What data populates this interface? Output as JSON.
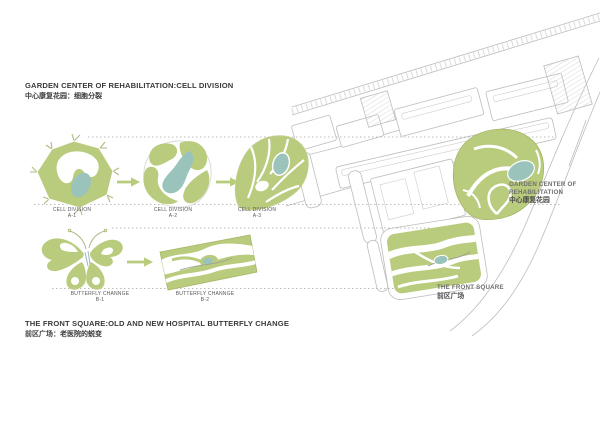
{
  "page": {
    "background": "#ffffff"
  },
  "colors": {
    "olive": "#b9cb7d",
    "olive-stroke": "#a6b665",
    "teal": "#9ac3bb",
    "map-line": "#bdbdbd",
    "dotted": "#a8a8a8",
    "title": "#3a3a3a",
    "step-label": "#575757",
    "map-label-en": "#6e6e6e",
    "map-label-zh": "#4c4c4c"
  },
  "cell_division_section": {
    "title_en": "GARDEN CENTER OF REHABILITATION:CELL DIVISION",
    "title_zh": "中心康复花园：细胞分裂",
    "steps": [
      {
        "name": "CELL DIVISION",
        "code": "A-1"
      },
      {
        "name": "CELL DIVISION",
        "code": "A-2"
      },
      {
        "name": "CELL DIVISION",
        "code": "A-3"
      }
    ]
  },
  "butterfly_section": {
    "title_en": "THE FRONT SQUARE:OLD AND NEW HOSPITAL BUTTERFLY CHANGE",
    "title_zh": "前区广场：老医院的蜕变",
    "steps": [
      {
        "name": "BUTTERFLY CHANNGE",
        "code": "B-1"
      },
      {
        "name": "BUTTERFLY CHANNGE",
        "code": "B-2"
      }
    ]
  },
  "site_plan": {
    "garden_label": {
      "en_line1": "GARDEN CENTER OF",
      "en_line2": "REHABILITATION",
      "zh": "中心康复花园"
    },
    "front_square_label": {
      "en": "THE FRONT SQUARE",
      "zh": "前区广场"
    }
  },
  "icons": {
    "arrow_right": "→"
  }
}
